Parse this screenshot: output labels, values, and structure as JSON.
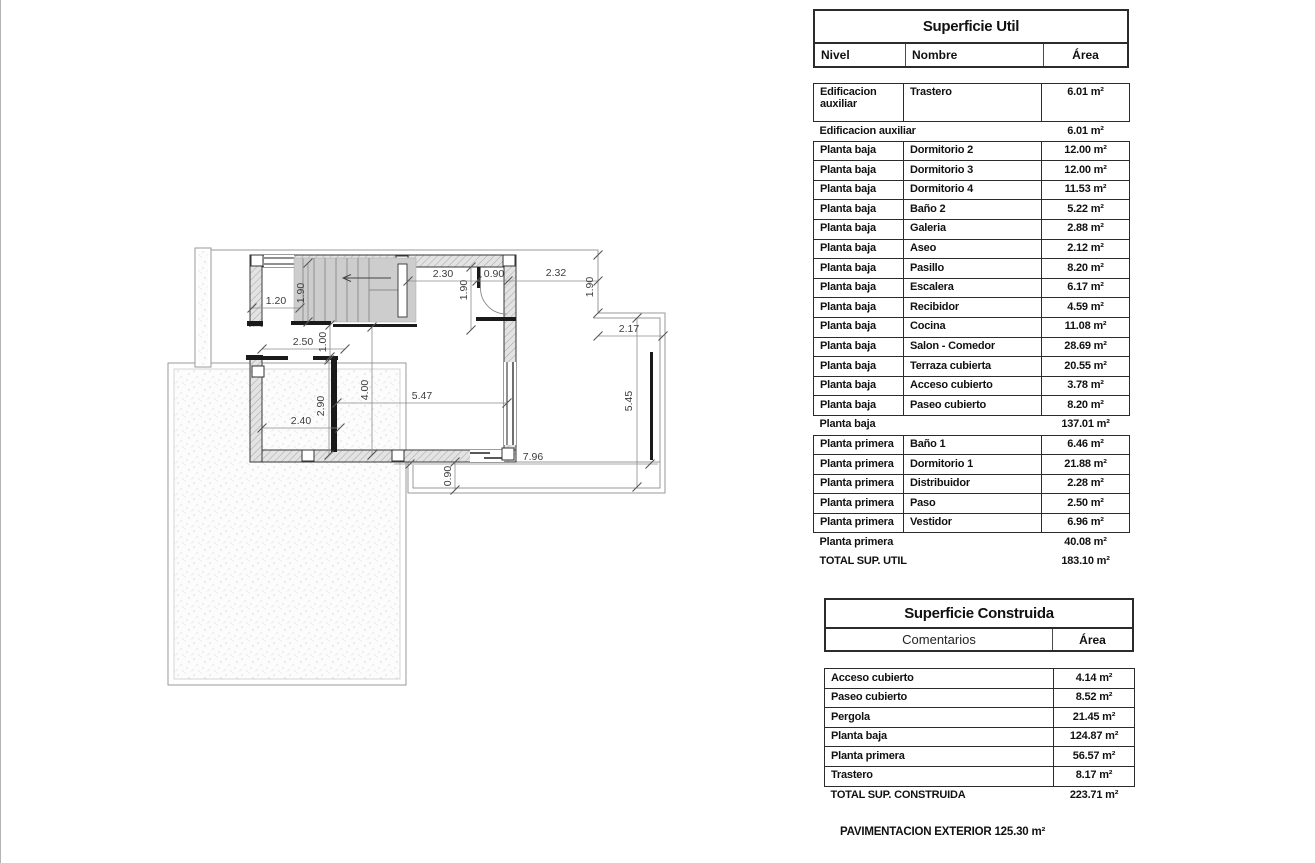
{
  "plan": {
    "dims": {
      "d120": "1.20",
      "d190": "1.90",
      "d230": "2.30",
      "d090": "0.90",
      "d232": "2.32",
      "d217": "2.17",
      "d250": "2.50",
      "d100": "1.00",
      "d290": "2.90",
      "d240": "2.40",
      "d400": "4.00",
      "d547": "5.47",
      "d545": "5.45",
      "d796": "7.96"
    }
  },
  "util": {
    "title": "Superficie Util",
    "col_nivel": "Nivel",
    "col_nombre": "Nombre",
    "col_area": "Área",
    "aux_row": {
      "nivel": "Edificacion auxiliar",
      "nombre": "Trastero",
      "area": "6.01 m²"
    },
    "aux_subtotal": {
      "label": "Edificacion auxiliar",
      "area": "6.01 m²"
    },
    "planta_baja_rows": [
      {
        "nivel": "Planta baja",
        "nombre": "Dormitorio 2",
        "area": "12.00 m²"
      },
      {
        "nivel": "Planta baja",
        "nombre": "Dormitorio 3",
        "area": "12.00 m²"
      },
      {
        "nivel": "Planta baja",
        "nombre": "Dormitorio 4",
        "area": "11.53 m²"
      },
      {
        "nivel": "Planta baja",
        "nombre": "Baño 2",
        "area": "5.22 m²"
      },
      {
        "nivel": "Planta baja",
        "nombre": "Galeria",
        "area": "2.88 m²"
      },
      {
        "nivel": "Planta baja",
        "nombre": "Aseo",
        "area": "2.12 m²"
      },
      {
        "nivel": "Planta baja",
        "nombre": "Pasillo",
        "area": "8.20 m²"
      },
      {
        "nivel": "Planta baja",
        "nombre": "Escalera",
        "area": "6.17 m²"
      },
      {
        "nivel": "Planta baja",
        "nombre": "Recibidor",
        "area": "4.59 m²"
      },
      {
        "nivel": "Planta baja",
        "nombre": "Cocina",
        "area": "11.08 m²"
      },
      {
        "nivel": "Planta baja",
        "nombre": "Salon - Comedor",
        "area": "28.69 m²"
      },
      {
        "nivel": "Planta baja",
        "nombre": "Terraza cubierta",
        "area": "20.55 m²"
      },
      {
        "nivel": "Planta baja",
        "nombre": "Acceso cubierto",
        "area": "3.78 m²"
      },
      {
        "nivel": "Planta baja",
        "nombre": "Paseo cubierto",
        "area": "8.20 m²"
      }
    ],
    "baja_subtotal": {
      "label": "Planta baja",
      "area": "137.01 m²"
    },
    "planta_primera_rows": [
      {
        "nivel": "Planta primera",
        "nombre": "Baño 1",
        "area": "6.46 m²"
      },
      {
        "nivel": "Planta primera",
        "nombre": "Dormitorio 1",
        "area": "21.88 m²"
      },
      {
        "nivel": "Planta primera",
        "nombre": "Distribuidor",
        "area": "2.28 m²"
      },
      {
        "nivel": "Planta primera",
        "nombre": "Paso",
        "area": "2.50 m²"
      },
      {
        "nivel": "Planta primera",
        "nombre": "Vestidor",
        "area": "6.96 m²"
      }
    ],
    "primera_subtotal": {
      "label": "Planta primera",
      "area": "40.08 m²"
    },
    "total": {
      "label": "TOTAL SUP. UTIL",
      "area": "183.10 m²"
    }
  },
  "construida": {
    "title": "Superficie Construida",
    "col_comentarios": "Comentarios",
    "col_area": "Área",
    "rows": [
      {
        "label": "Acceso cubierto",
        "area": "4.14 m²"
      },
      {
        "label": "Paseo cubierto",
        "area": "8.52 m²"
      },
      {
        "label": "Pergola",
        "area": "21.45 m²"
      },
      {
        "label": "Planta baja",
        "area": "124.87 m²"
      },
      {
        "label": "Planta primera",
        "area": "56.57 m²"
      },
      {
        "label": "Trastero",
        "area": "8.17 m²"
      }
    ],
    "total": {
      "label": "TOTAL SUP. CONSTRUIDA",
      "area": "223.71 m²"
    }
  },
  "footer": {
    "pavimentacion": "PAVIMENTACION EXTERIOR 125.30 m²"
  }
}
